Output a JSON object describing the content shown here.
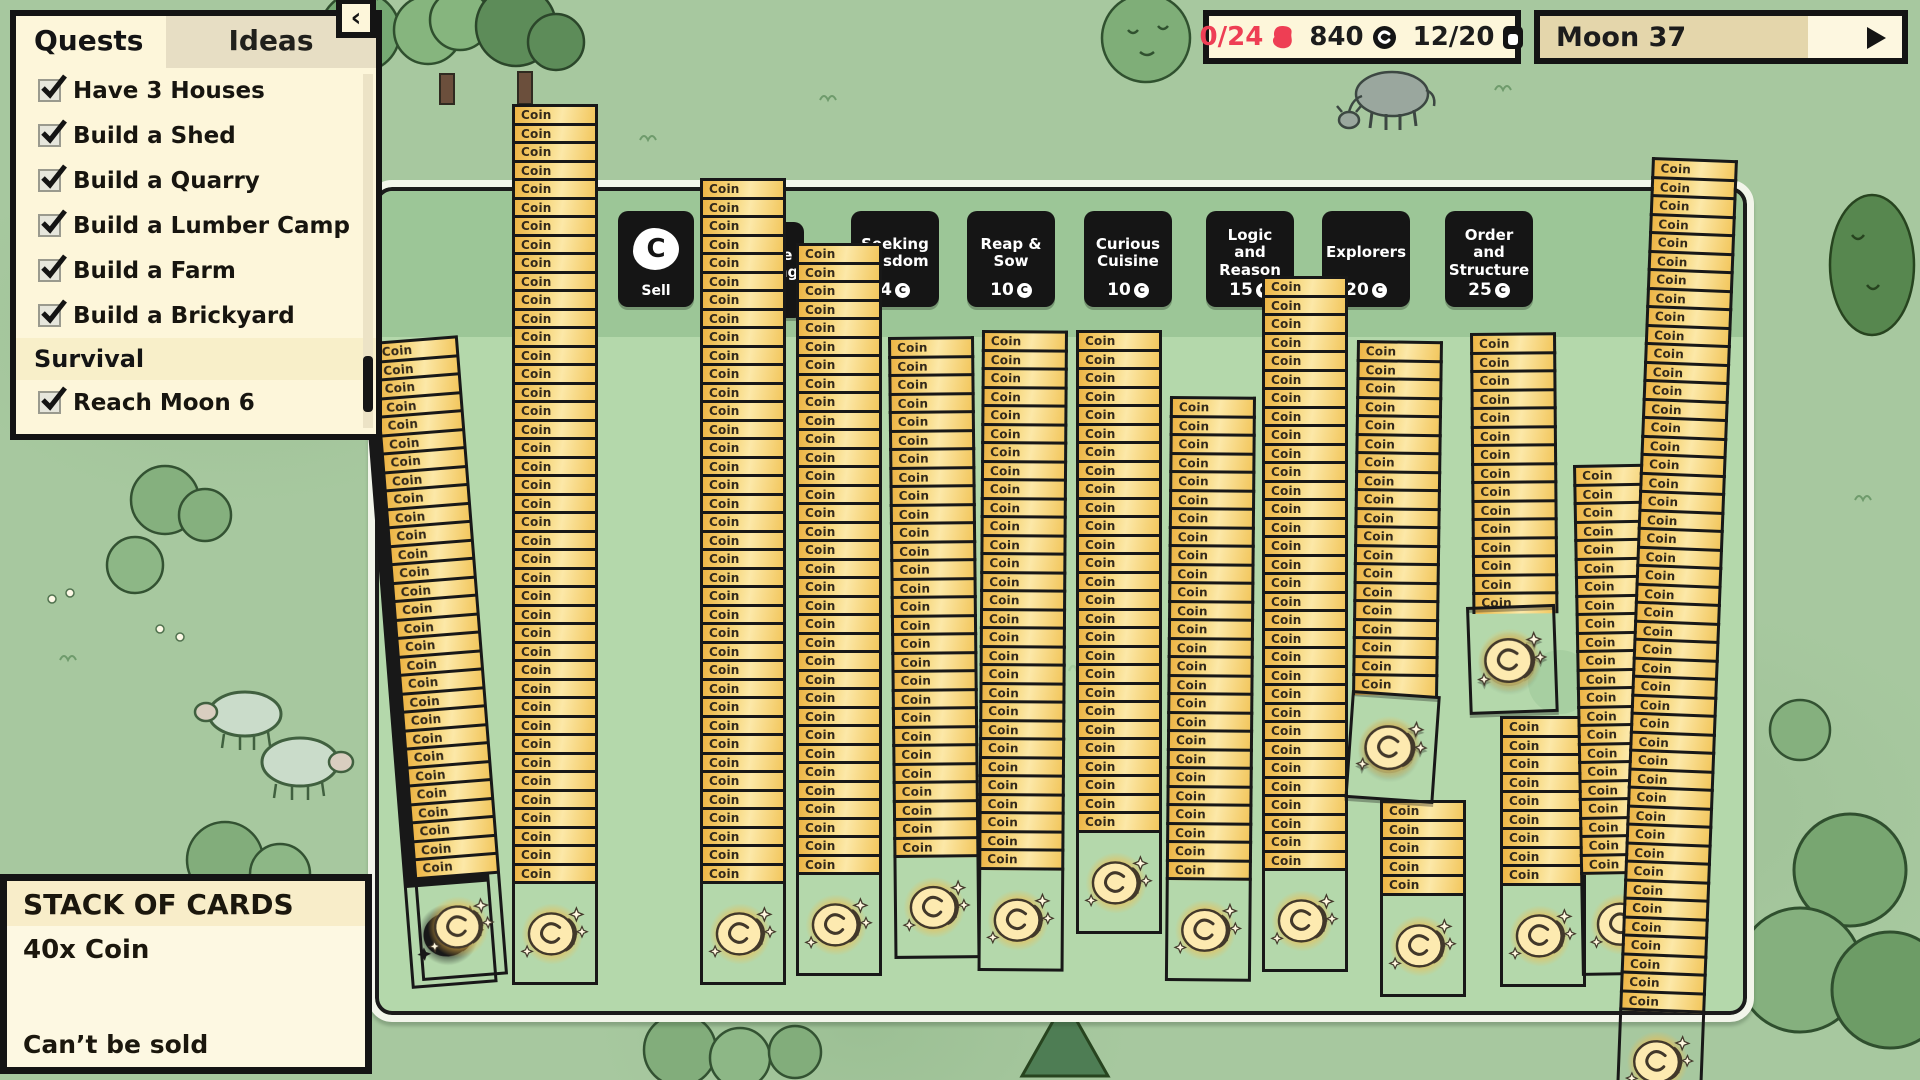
{
  "quests_panel": {
    "tabs": {
      "quests": "Quests",
      "ideas": "Ideas"
    },
    "collapse_icon": "‹",
    "items": [
      {
        "label": "Have 3 Houses",
        "checked": true
      },
      {
        "label": "Build a Shed",
        "checked": true
      },
      {
        "label": "Build a Quarry",
        "checked": true
      },
      {
        "label": "Build a Lumber Camp",
        "checked": true
      },
      {
        "label": "Build a Farm",
        "checked": true
      },
      {
        "label": "Build a Brickyard",
        "checked": true
      },
      {
        "label": "Survival",
        "type": "section"
      },
      {
        "label": "Reach Moon 6",
        "checked": true
      }
    ]
  },
  "stats": {
    "quota": "0/24",
    "coins": "840",
    "cards": "12/20"
  },
  "moon": {
    "label": "Moon 37",
    "progress_pct": 74
  },
  "icons": {
    "coin_letter": "C"
  },
  "sell_card": {
    "label": "Sell"
  },
  "packs": [
    {
      "name": "Humble Beginnings",
      "price": ""
    },
    {
      "name": "Seeking Wisdom",
      "price": "4"
    },
    {
      "name": "Reap & Sow",
      "price": "10"
    },
    {
      "name": "Curious Cuisine",
      "price": "10"
    },
    {
      "name": "Logic and Reason",
      "price": "15"
    },
    {
      "name": "Explorers",
      "price": "20"
    },
    {
      "name": "Order and Structure",
      "price": "25"
    }
  ],
  "card": {
    "title": "Coin"
  },
  "tooltip": {
    "title": "STACK OF CARDS",
    "line1": "40x Coin",
    "footer": "Can’t be sold"
  },
  "board": {
    "stacks": [
      {
        "x": 372,
        "y": 342,
        "rows": 29,
        "rot": -4.5,
        "art": true,
        "double": true
      },
      {
        "x": 512,
        "y": 104,
        "rows": 42,
        "rot": 0,
        "art": true
      },
      {
        "x": 700,
        "y": 178,
        "rows": 38,
        "rot": 0,
        "art": true
      },
      {
        "x": 796,
        "y": 243,
        "rows": 34,
        "rot": 0,
        "art": true
      },
      {
        "x": 888,
        "y": 337,
        "rows": 28,
        "rot": -0.6,
        "art": true
      },
      {
        "x": 982,
        "y": 330,
        "rows": 29,
        "rot": 0.4,
        "art": true
      },
      {
        "x": 1076,
        "y": 330,
        "rows": 27,
        "rot": 0,
        "art": true
      },
      {
        "x": 1170,
        "y": 396,
        "rows": 26,
        "rot": 0.5,
        "art": true
      },
      {
        "x": 1262,
        "y": 276,
        "rows": 32,
        "rot": 0,
        "art": true
      },
      {
        "x": 1357,
        "y": 340,
        "rows": 19,
        "rot": 0.8,
        "art": false
      },
      {
        "x": 1380,
        "y": 800,
        "rows": 5,
        "rot": 0,
        "art": true
      },
      {
        "x": 1470,
        "y": 333,
        "rows": 15,
        "rot": -0.5,
        "art": false
      },
      {
        "x": 1500,
        "y": 716,
        "rows": 9,
        "rot": 0,
        "art": true
      },
      {
        "x": 1573,
        "y": 465,
        "rows": 22,
        "rot": -1,
        "art": true
      },
      {
        "x": 1652,
        "y": 157,
        "rows": 46,
        "rot": 2.2,
        "art": true
      }
    ],
    "loose_cards": [
      {
        "x": 1352,
        "y": 690,
        "rot": 4
      },
      {
        "x": 1466,
        "y": 607,
        "rot": -2
      }
    ]
  }
}
